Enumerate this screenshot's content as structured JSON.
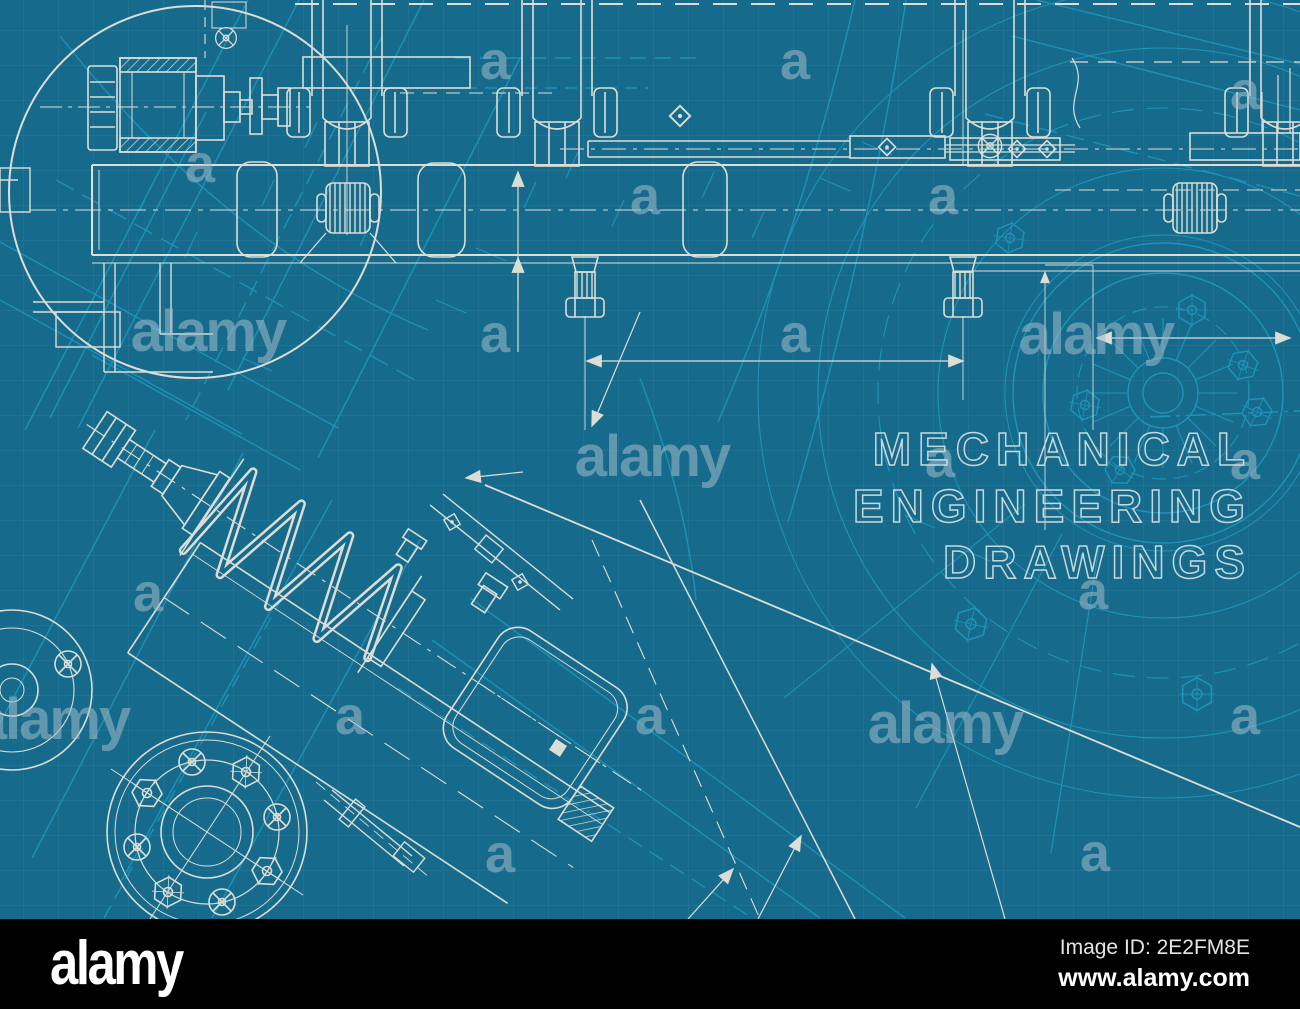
{
  "artwork": {
    "type": "blueprint-technical-illustration",
    "caption_lines": [
      "MECHANICAL",
      "ENGINEERING",
      "DRAWINGS"
    ]
  },
  "watermark": {
    "letter": "a",
    "word": "alamy"
  },
  "footer": {
    "logo": "alamy",
    "image_id": "Image ID: 2E2FM8E",
    "website": "www.alamy.com"
  },
  "colors": {
    "background": "#166b8d",
    "grid": "#bfe3ef",
    "underlay_drawing": "#1e94b8",
    "main_drawing": "#dcded6",
    "caption_outline": "#c7d8db",
    "watermark": "#a3bcc8",
    "footer_bar": "#000000",
    "footer_text": "#ffffff"
  }
}
